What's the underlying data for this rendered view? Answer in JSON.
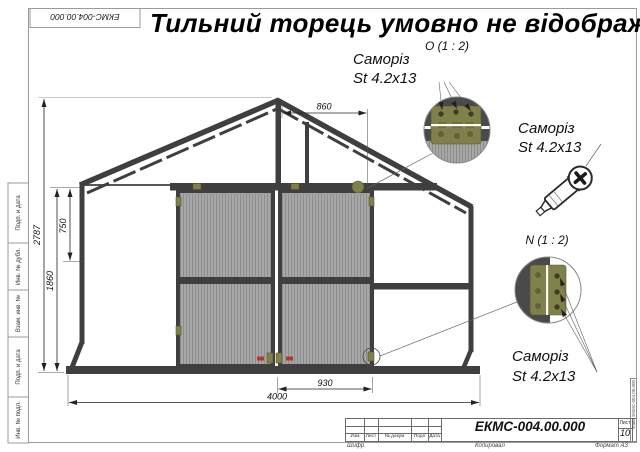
{
  "title": "Тильний торець умовно не відображ",
  "corner_stamp": "ЕКМС-004.00.000",
  "dims": {
    "total_height": "2787",
    "upper_height": "750",
    "door_height": "1860",
    "ridge_offset": "860",
    "door_width": "930",
    "total_width": "4000"
  },
  "callouts": {
    "o_label": "О (1 : 2)",
    "n_label": "N (1 : 2)",
    "screw1_line1": "Саморіз",
    "screw1_line2": "St 4.2x13",
    "screw2_line1": "Саморіз",
    "screw2_line2": "St 4.2x13",
    "screw3_line1": "Саморіз",
    "screw3_line2": "St 4.2x13"
  },
  "frame": {
    "side_cells": [
      "Подп. и дата",
      "Инв. № дубл.",
      "Взам. инв. №",
      "Подп. и дата",
      "Инв. № подл."
    ]
  },
  "title_block": {
    "doc_number": "ЕКМС-004.00.000",
    "columns": [
      "Изм",
      "Лист",
      "№ докум",
      "Подп",
      "Дата"
    ],
    "sheet_label": "Лист",
    "sheet_value": "10",
    "footer_code": "Шифр",
    "footer_copied": "Копировал",
    "footer_format": "Формат А3",
    "file_label": "Файл ЕКМС-004.00.000"
  },
  "colors": {
    "structure": "#3f3f3f",
    "panel": "#a7a7a7",
    "panel-stripe": "#8d8d8d",
    "hinge": "#80804a",
    "hinge-dark": "#55552e",
    "red": "#b23a2a",
    "frame-line": "#9a9a9a",
    "draw-line": "#222222"
  }
}
